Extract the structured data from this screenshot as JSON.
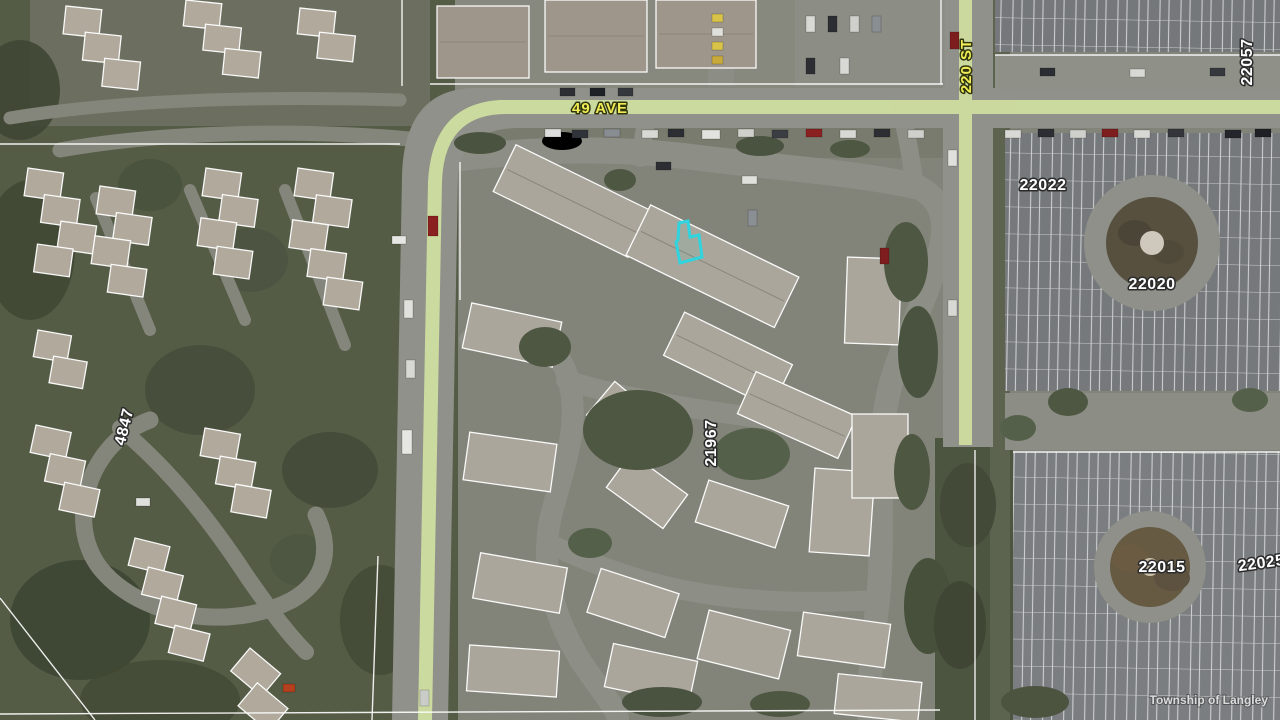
{
  "map": {
    "streets": {
      "ave49": "49 AVE",
      "st220": "220 ST"
    },
    "parcels": {
      "p22057": "22057",
      "p22022": "22022",
      "p22020": "22020",
      "p21967": "21967",
      "p4847": "4847",
      "p22015": "22015",
      "p22025": "22025"
    },
    "watermark": "Township of Langley",
    "colors": {
      "highlight": "#2fd4de",
      "street_label": "#f0ec55",
      "parcel_label": "#ffffff",
      "road_stripe": "#d6e6a2"
    }
  }
}
